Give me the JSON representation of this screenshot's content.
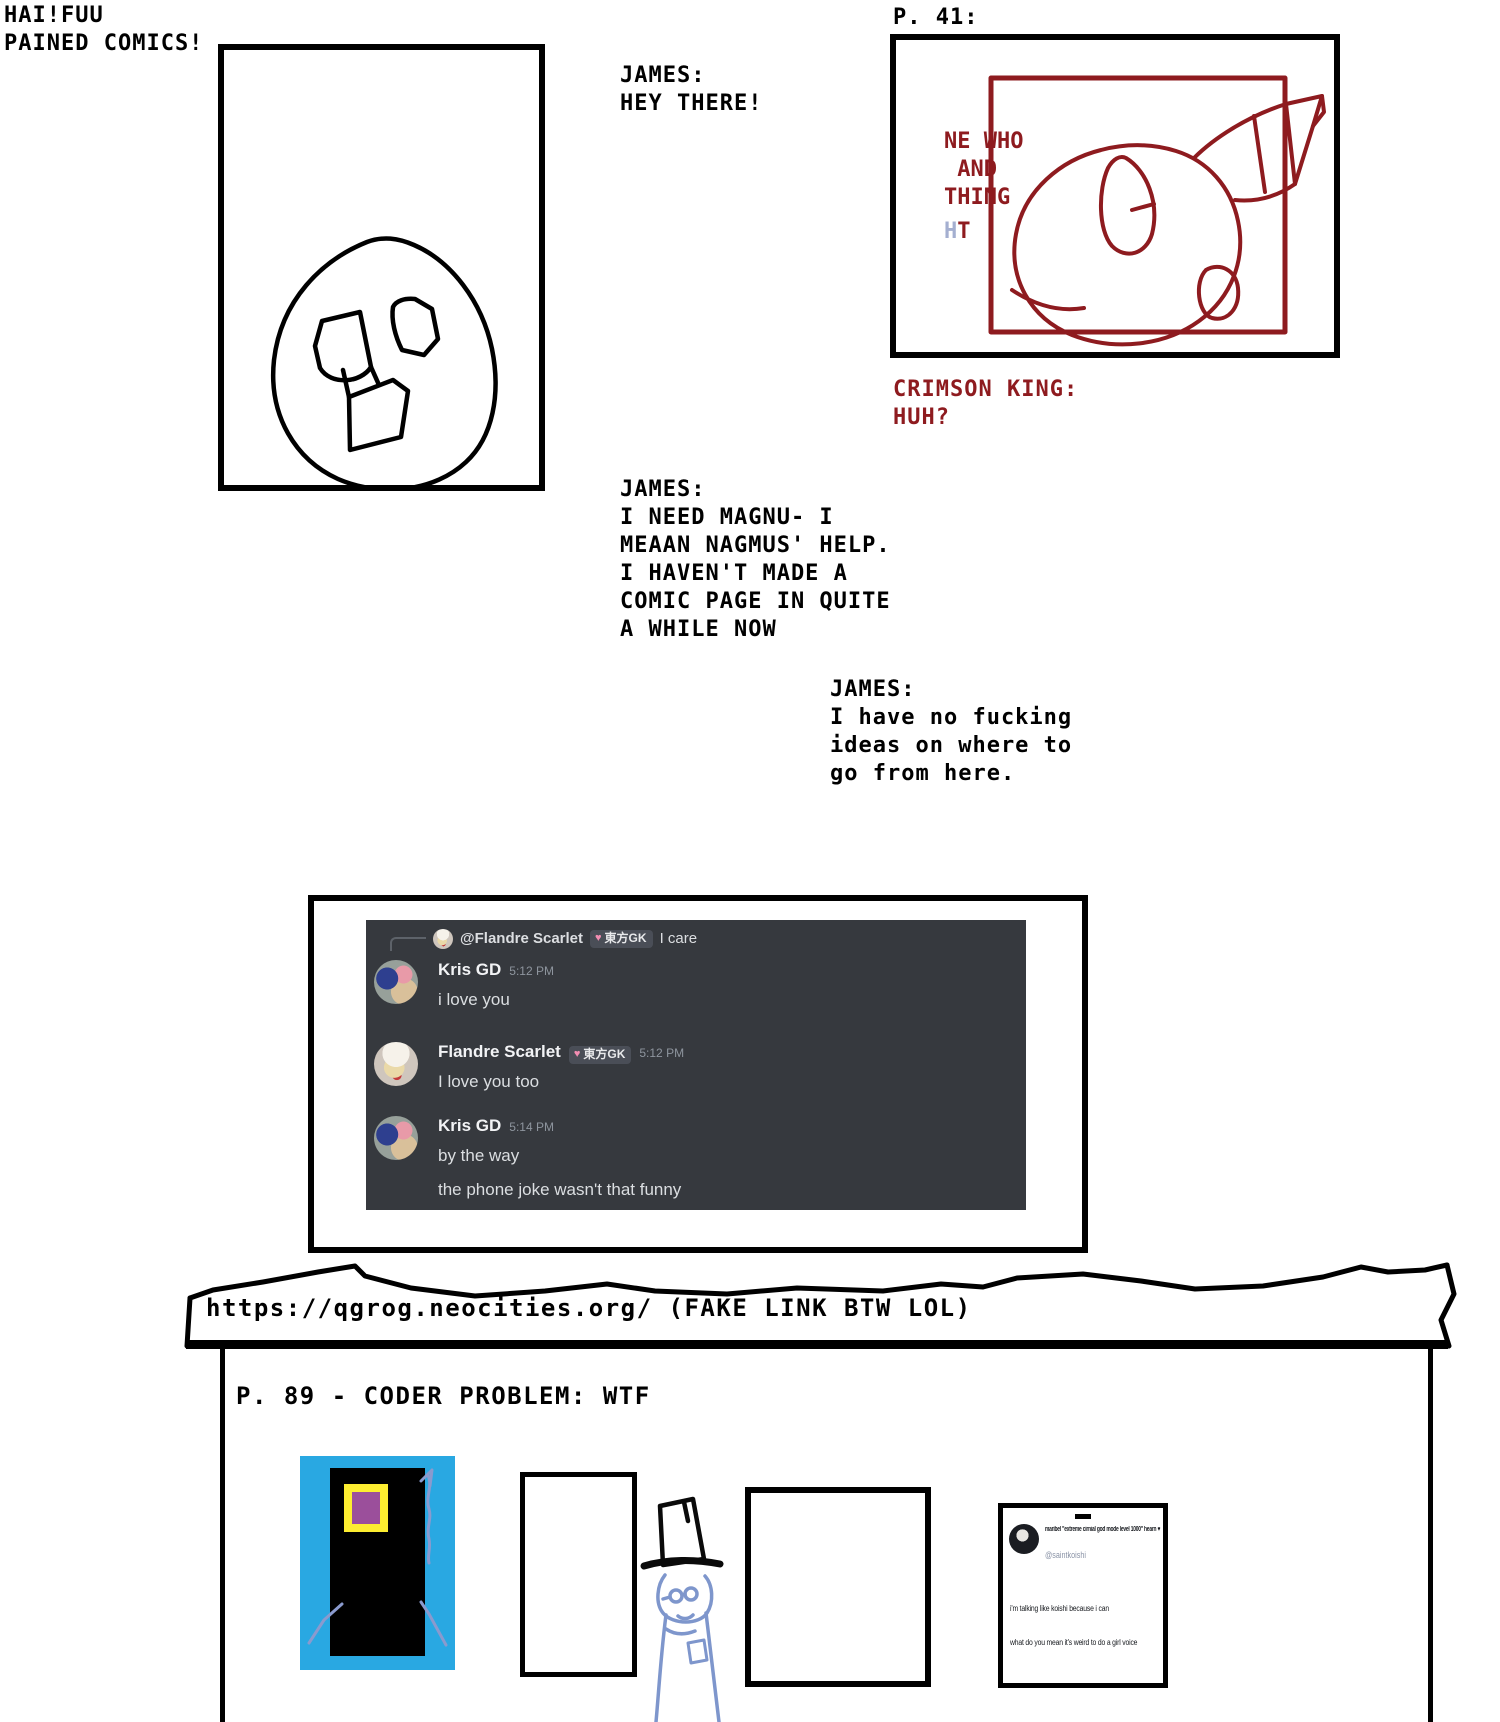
{
  "title": {
    "line1": "HAI!FUU",
    "line2": "PAINED COMICS!"
  },
  "dialogue1": {
    "speaker": "JAMES:",
    "line1": "HEY THERE!"
  },
  "page41": {
    "label": "P. 41:",
    "inpanel_line1": "NE WHO",
    "inpanel_line2": " AND",
    "inpanel_line3": "THING",
    "faint_h": "H",
    "faint_t": "T"
  },
  "crimson_king": {
    "speaker": "CRIMSON KING:",
    "line1": "HUH?"
  },
  "dialogue2": {
    "speaker": "JAMES:",
    "lines": [
      "I NEED MAGNU- I",
      "MEAAN NAGMUS' HELP.",
      "I HAVEN'T MADE A",
      "COMIC PAGE IN QUITE",
      "A WHILE NOW"
    ]
  },
  "dialogue3": {
    "speaker": "JAMES:",
    "lines": [
      "I have no fucking",
      "ideas on where to",
      "go from here."
    ]
  },
  "discord": {
    "reply": {
      "mention": "@Flandre Scarlet",
      "badge_heart": "♥",
      "badge_text": "東方GK",
      "message": "I care"
    },
    "messages": [
      {
        "author": "Kris GD",
        "timestamp": "5:12 PM",
        "line1": "i love you"
      },
      {
        "author": "Flandre Scarlet",
        "badge_heart": "♥",
        "badge_text": "東方GK",
        "timestamp": "5:12 PM",
        "line1": "I love you too"
      },
      {
        "author": "Kris GD",
        "timestamp": "5:14 PM",
        "line1": "by the way",
        "line2": "the phone joke wasn't that funny"
      }
    ]
  },
  "browser": {
    "url": "https://qgrog.neocities.org/ (FAKE LINK BTW LOL)",
    "page_heading": "P. 89 - CODER PROBLEM: WTF"
  },
  "tweet": {
    "display_name": "maribel \"extreme cirnial god mode level 1000\" hearn",
    "heart": "♥",
    "handle": "@saintkoishi",
    "line1": "i'm talking like koishi because i can",
    "line2": "what do you mean it's weird to do a girl voice"
  },
  "colors": {
    "crimson": "#8e1b1f",
    "discord_bg": "#36393e",
    "door_blue": "#29a8e2",
    "door_yellow": "#fdee30",
    "door_purple": "#9b4f9b",
    "sketch_periwinkle": "#8a9ace"
  }
}
